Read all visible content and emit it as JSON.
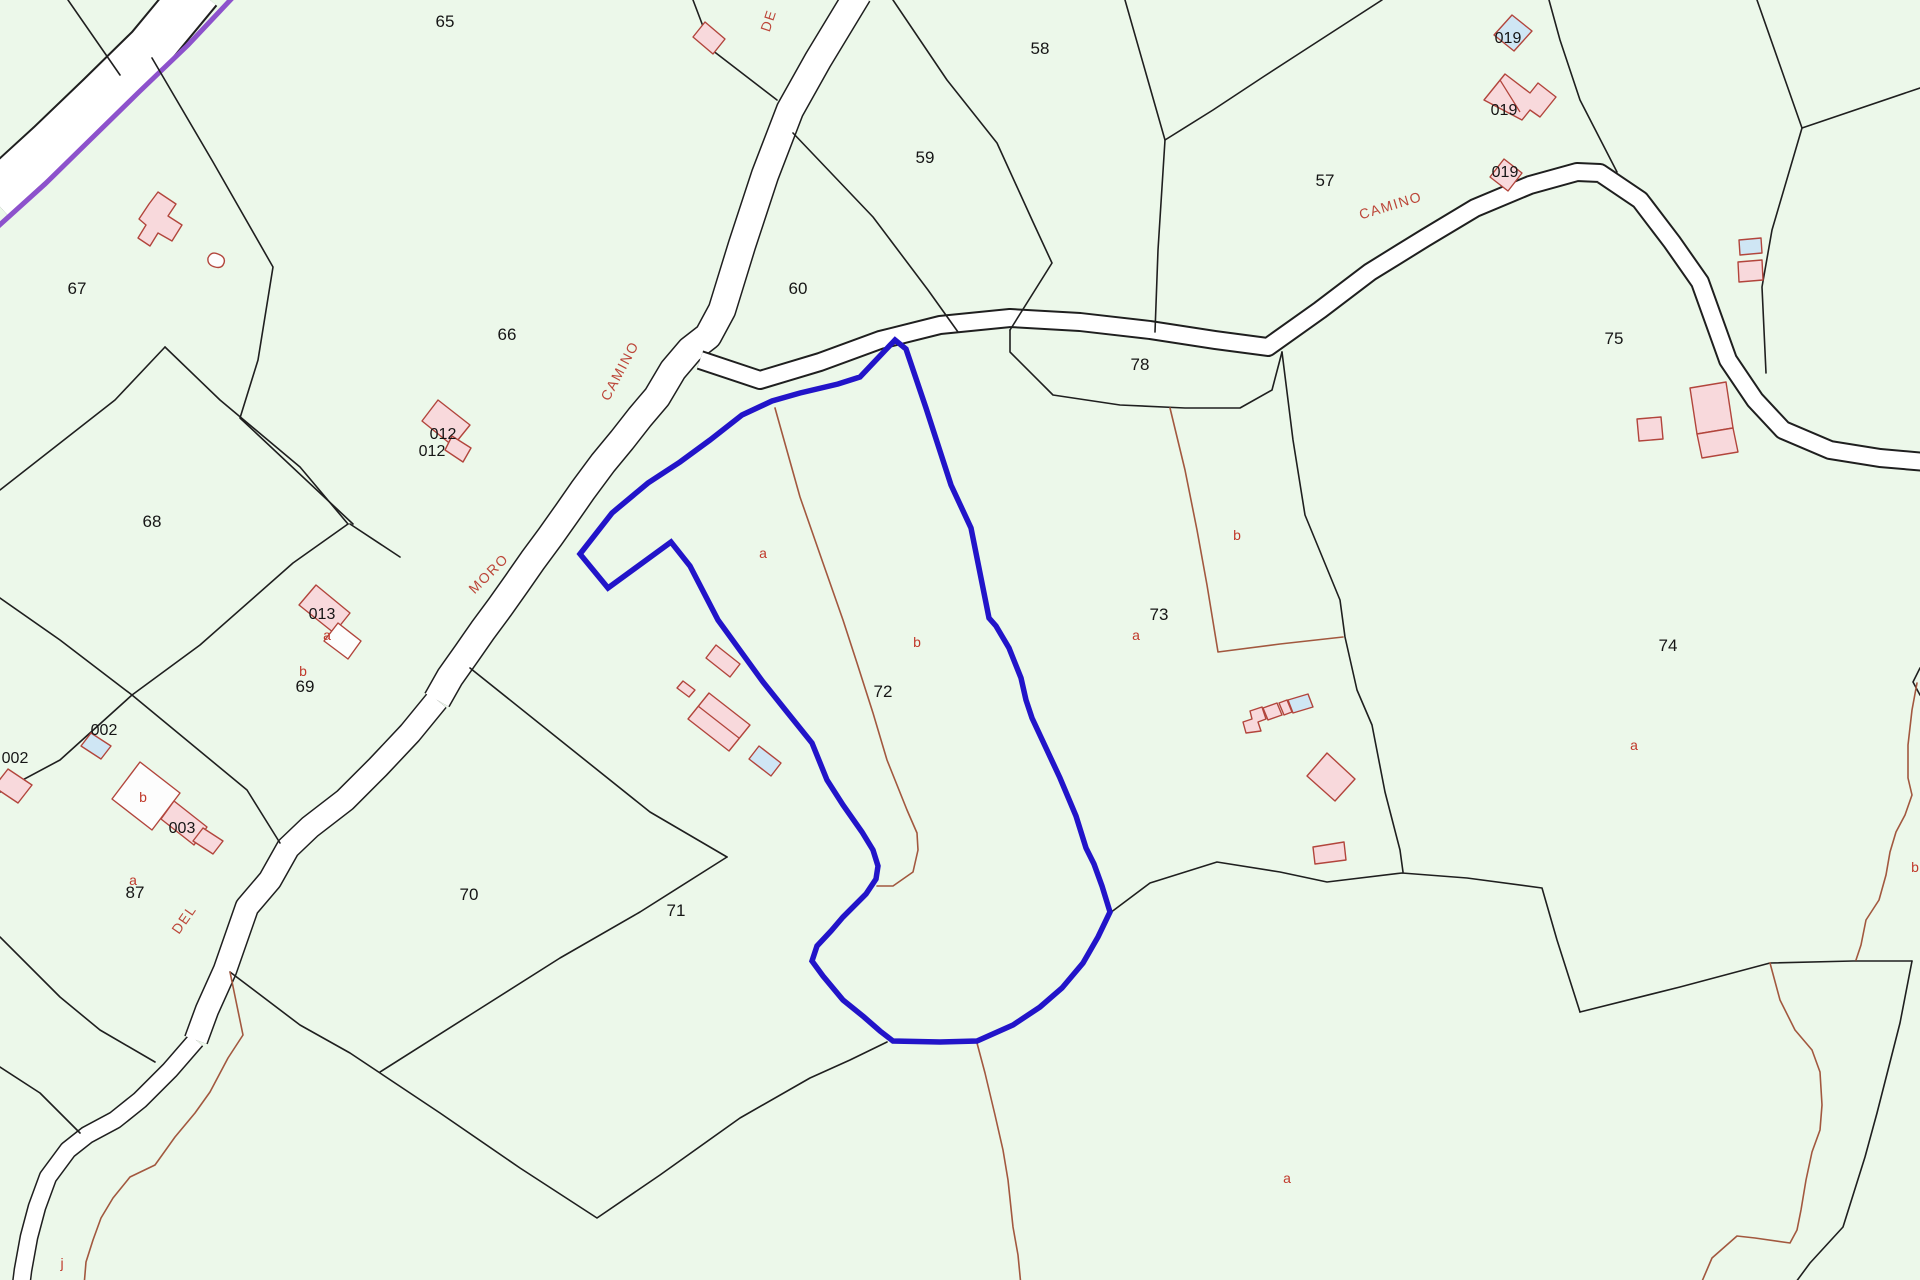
{
  "map": {
    "type": "cadastral-parcel-map",
    "background_color": "#ecf8ea",
    "highlight_color": "#2214c9",
    "road_fill": "#ffffff",
    "boundary_color": "#1f1f1f",
    "subparcel_line_color": "#a2583f",
    "livestock_track_color": "#8d52cc",
    "building_fill": "#f8d9dc",
    "building_alt_fill": "#cfe6f4",
    "building_stroke": "#b2453c",
    "highlighted_parcel": {
      "number": "72",
      "subparcels": [
        "a",
        "b"
      ]
    }
  },
  "parcel_labels": [
    {
      "text": "65",
      "x": 445,
      "y": 27
    },
    {
      "text": "58",
      "x": 1040,
      "y": 54
    },
    {
      "text": "59",
      "x": 925,
      "y": 163
    },
    {
      "text": "57",
      "x": 1325,
      "y": 186
    },
    {
      "text": "60",
      "x": 798,
      "y": 294
    },
    {
      "text": "66",
      "x": 507,
      "y": 340
    },
    {
      "text": "67",
      "x": 77,
      "y": 294
    },
    {
      "text": "68",
      "x": 152,
      "y": 527
    },
    {
      "text": "69",
      "x": 305,
      "y": 692
    },
    {
      "text": "70",
      "x": 469,
      "y": 900
    },
    {
      "text": "71",
      "x": 676,
      "y": 916
    },
    {
      "text": "72",
      "x": 883,
      "y": 697
    },
    {
      "text": "73",
      "x": 1159,
      "y": 620
    },
    {
      "text": "74",
      "x": 1668,
      "y": 651
    },
    {
      "text": "75",
      "x": 1614,
      "y": 344
    },
    {
      "text": "78",
      "x": 1140,
      "y": 370
    },
    {
      "text": "87",
      "x": 135,
      "y": 898
    }
  ],
  "building_labels": [
    {
      "text": "012",
      "x": 443,
      "y": 439
    },
    {
      "text": "012",
      "x": 432,
      "y": 456
    },
    {
      "text": "013",
      "x": 322,
      "y": 619
    },
    {
      "text": "002",
      "x": 104,
      "y": 735
    },
    {
      "text": "002",
      "x": 15,
      "y": 763
    },
    {
      "text": "003",
      "x": 182,
      "y": 833
    },
    {
      "text": "019",
      "x": 1508,
      "y": 43
    },
    {
      "text": "019",
      "x": 1504,
      "y": 115
    },
    {
      "text": "019",
      "x": 1505,
      "y": 177
    }
  ],
  "subparcel_labels": [
    {
      "text": "a",
      "x": 763,
      "y": 558
    },
    {
      "text": "b",
      "x": 917,
      "y": 647
    },
    {
      "text": "a",
      "x": 1136,
      "y": 640
    },
    {
      "text": "b",
      "x": 1237,
      "y": 540
    },
    {
      "text": "a",
      "x": 1634,
      "y": 750
    },
    {
      "text": "b",
      "x": 1915,
      "y": 872
    },
    {
      "text": "a",
      "x": 1287,
      "y": 1183
    },
    {
      "text": "a",
      "x": 327,
      "y": 640
    },
    {
      "text": "b",
      "x": 303,
      "y": 676
    },
    {
      "text": "b",
      "x": 143,
      "y": 802
    },
    {
      "text": "a",
      "x": 133,
      "y": 885
    },
    {
      "text": "j",
      "x": 62,
      "y": 1268
    }
  ],
  "road_labels": [
    {
      "text": "DE",
      "x": 773,
      "y": 22,
      "rot": -72
    },
    {
      "text": "CAMINO",
      "x": 624,
      "y": 373,
      "rot": -62
    },
    {
      "text": "MORO",
      "x": 492,
      "y": 577,
      "rot": -45
    },
    {
      "text": "DEL",
      "x": 188,
      "y": 922,
      "rot": -55
    },
    {
      "text": "CAMINO",
      "x": 1392,
      "y": 210,
      "rot": -17
    }
  ]
}
